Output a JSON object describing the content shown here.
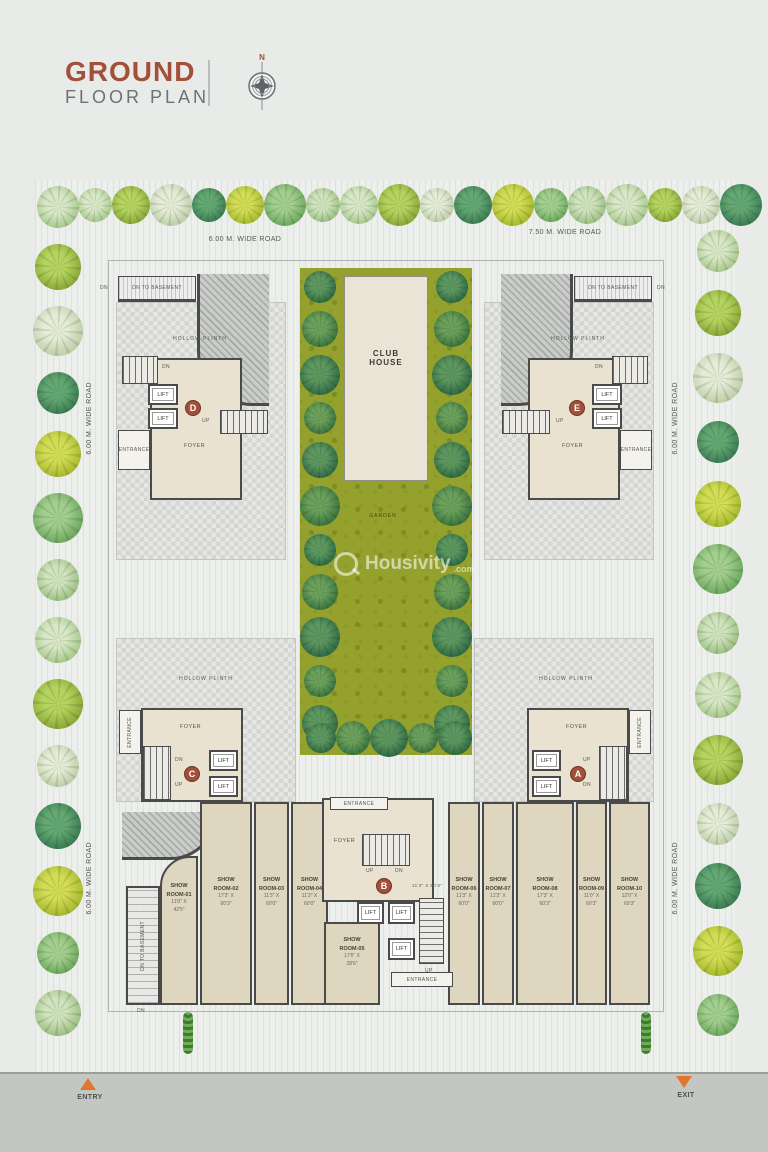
{
  "header": {
    "title_line1": "GROUND",
    "title_line2": "FLOOR PLAN",
    "compass_north": "N"
  },
  "roads": {
    "top_left": "6.00 M. WIDE ROAD",
    "top_right": "7.50 M. WIDE ROAD",
    "side": "6.00 M. WIDE ROAD"
  },
  "labels": {
    "lift": "LIFT",
    "foyer": "FOYER",
    "entrance": "ENTRANCE",
    "up": "UP",
    "dn": "DN",
    "hollow_plinth": "HOLLOW PLINTH",
    "dn_to_basement": "DN TO BASEMENT",
    "garden": "GARDEN",
    "club_house_line1": "CLUB",
    "club_house_line2": "HOUSE"
  },
  "towers": {
    "a": "A",
    "b": "B",
    "c": "C",
    "d": "D",
    "e": "E"
  },
  "dimensions": {
    "beside_b": "11'3\" X 50'3\""
  },
  "showrooms": [
    {
      "line1": "SHOW",
      "line2": "ROOM-01",
      "size1": "11'0\" X",
      "size2": "42'5\""
    },
    {
      "line1": "SHOW",
      "line2": "ROOM-02",
      "size1": "17'3\" X",
      "size2": "60'3\""
    },
    {
      "line1": "SHOW",
      "line2": "ROOM-03",
      "size1": "11'3\" X",
      "size2": "60'0\""
    },
    {
      "line1": "SHOW",
      "line2": "ROOM-04",
      "size1": "11'3\" X",
      "size2": "60'0\""
    },
    {
      "line1": "SHOW",
      "line2": "ROOM-05",
      "size1": "17'6\" X",
      "size2": "28'6\""
    },
    {
      "line1": "SHOW",
      "line2": "ROOM-06",
      "size1": "11'3\" X",
      "size2": "60'0\""
    },
    {
      "line1": "SHOW",
      "line2": "ROOM-07",
      "size1": "11'3\" X",
      "size2": "60'0\""
    },
    {
      "line1": "SHOW",
      "line2": "ROOM-08",
      "size1": "17'3\" X",
      "size2": "60'3\""
    },
    {
      "line1": "SHOW",
      "line2": "ROOM-09",
      "size1": "11'0\" X",
      "size2": "60'3\""
    },
    {
      "line1": "SHOW",
      "line2": "ROOM-10",
      "size1": "12'0\" X",
      "size2": "60'3\""
    }
  ],
  "footer": {
    "entry": "ENTRY",
    "exit": "EXIT"
  },
  "watermark": {
    "brand": "Housivity",
    "tld": ".com"
  },
  "palette": {
    "accent": "#A2503A",
    "garden_green": "#95A12D",
    "road_band": "#C3C6C3",
    "marker_orange": "#E0772E",
    "wall": "#4A4A4A",
    "showroom_beige": "#DED6BF"
  }
}
